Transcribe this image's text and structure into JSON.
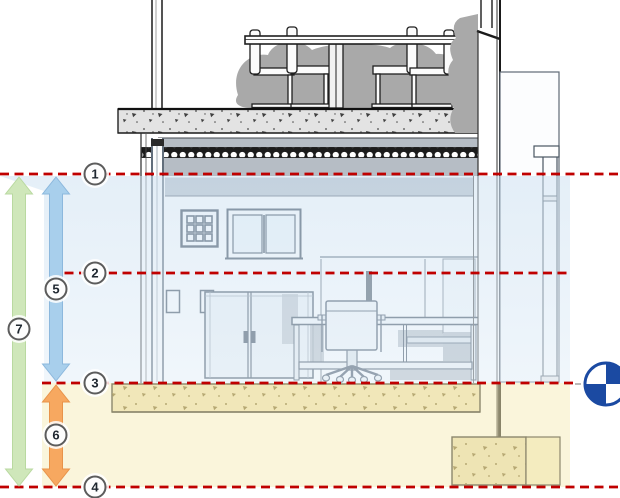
{
  "drawing": {
    "type": "building-section-level-diagram",
    "level_line_color": "#c00000",
    "level_lines": [
      {
        "marker": "1"
      },
      {
        "marker": "2"
      },
      {
        "marker": "3"
      },
      {
        "marker": "4"
      }
    ],
    "dimension_arrows": [
      {
        "marker": "5",
        "color": "#a8cfec",
        "from_level": "1",
        "to_level": "3"
      },
      {
        "marker": "6",
        "color": "#f7a860",
        "from_level": "3",
        "to_level": "4"
      },
      {
        "marker": "7",
        "color": "#cfe7ba",
        "from_level": "1",
        "to_level": "4"
      }
    ],
    "zones": {
      "upper_fill": "#dcebf7",
      "lower_fill": "#f6ecb8"
    },
    "survey_point_color": "#1b4aa2"
  }
}
